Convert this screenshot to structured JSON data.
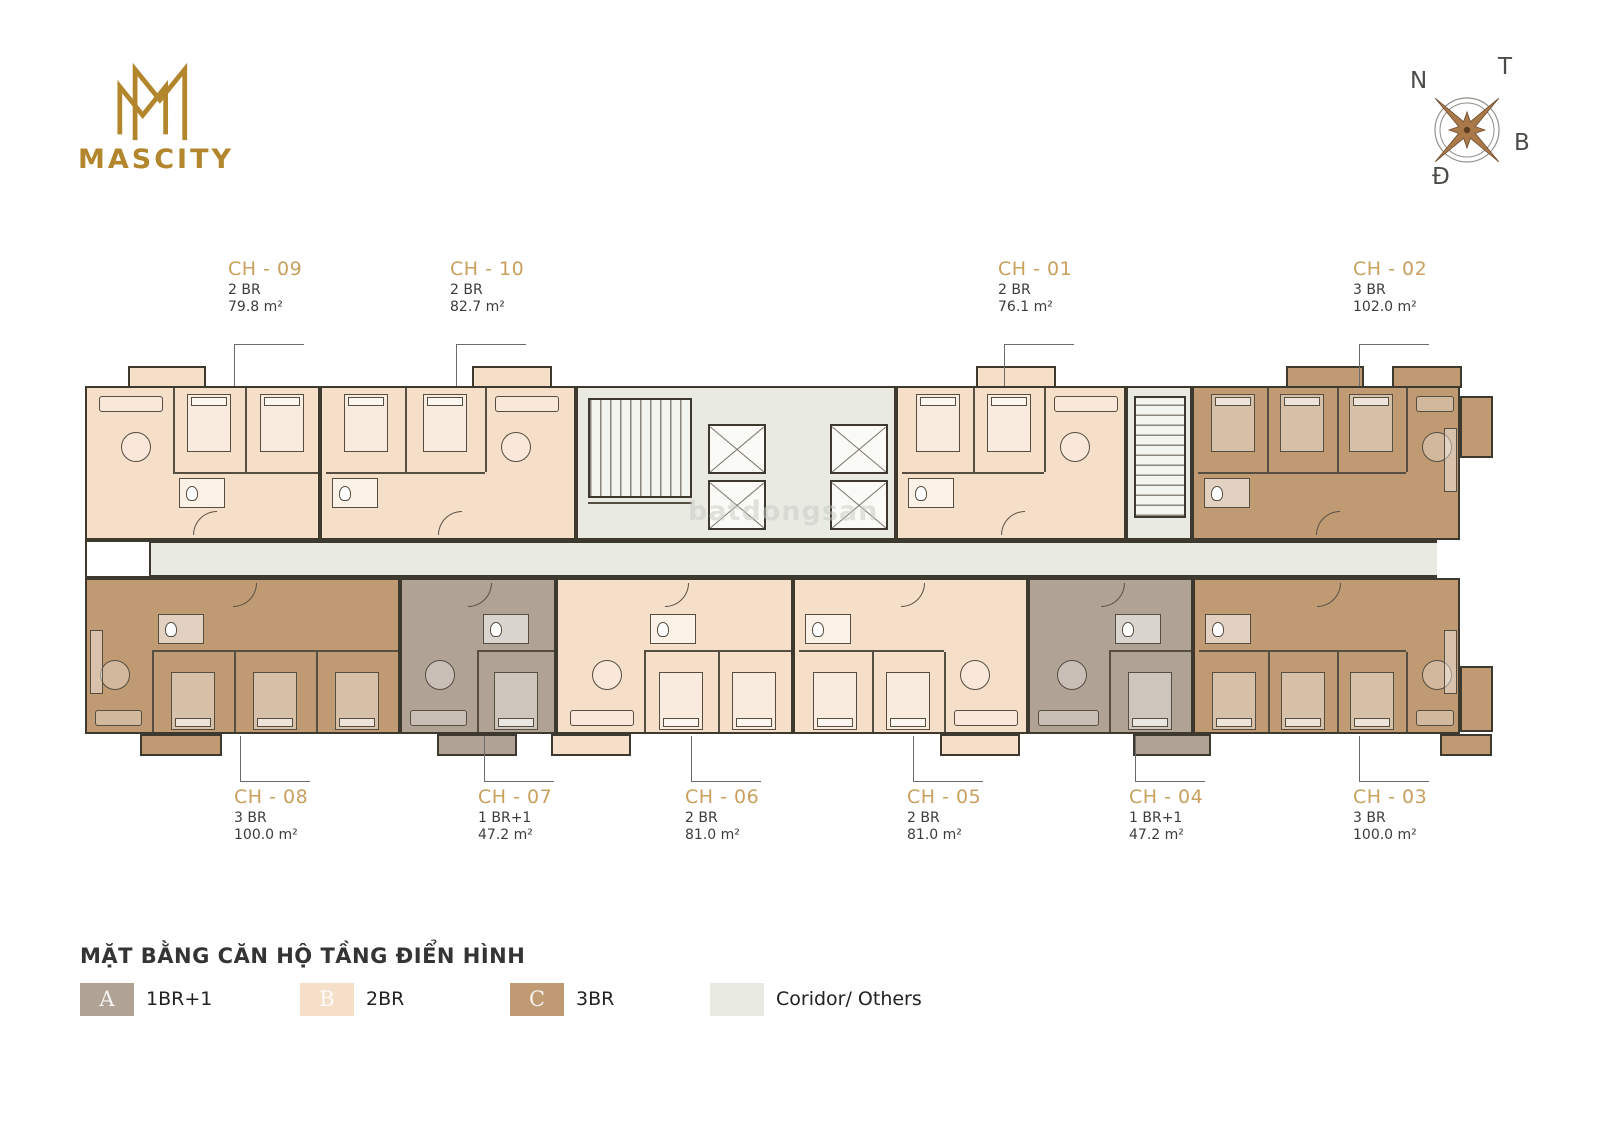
{
  "brand": {
    "logo_text": "MASCITY"
  },
  "compass": {
    "top_left": "N",
    "top_right": "T",
    "bottom_right": "B",
    "bottom_left": "Đ"
  },
  "watermark": {
    "text": "batdongsan"
  },
  "colors": {
    "gold": "#B1862C",
    "label_gold": "#C9A05E",
    "wall": "#3E392F",
    "wall2": "#554E41",
    "one_br": "#B0A295",
    "two_br": "#F6DFC9",
    "three_br": "#BF9A73",
    "corridor": "#E9EBE2"
  },
  "units": [
    {
      "id": "CH - 09",
      "bedrooms_label": "2 BR",
      "area": "79.8 m²",
      "type": "2BR"
    },
    {
      "id": "CH - 10",
      "bedrooms_label": "2 BR",
      "area": "82.7 m²",
      "type": "2BR"
    },
    {
      "id": "CH - 01",
      "bedrooms_label": "2 BR",
      "area": "76.1 m²",
      "type": "2BR"
    },
    {
      "id": "CH - 02",
      "bedrooms_label": "3 BR",
      "area": "102.0 m²",
      "type": "3BR"
    },
    {
      "id": "CH - 08",
      "bedrooms_label": "3 BR",
      "area": "100.0 m²",
      "type": "3BR"
    },
    {
      "id": "CH - 07",
      "bedrooms_label": "1 BR+1",
      "area": "47.2 m²",
      "type": "1BR+1"
    },
    {
      "id": "CH - 06",
      "bedrooms_label": "2 BR",
      "area": "81.0 m²",
      "type": "2BR"
    },
    {
      "id": "CH - 05",
      "bedrooms_label": "2 BR",
      "area": "81.0 m²",
      "type": "2BR"
    },
    {
      "id": "CH - 04",
      "bedrooms_label": "1 BR+1",
      "area": "47.2 m²",
      "type": "1BR+1"
    },
    {
      "id": "CH - 03",
      "bedrooms_label": "3 BR",
      "area": "100.0 m²",
      "type": "3BR"
    }
  ],
  "legend": {
    "title": "MẶT BẰNG CĂN HỘ TẦNG ĐIỂN HÌNH",
    "items": [
      {
        "letter": "A",
        "label": "1BR+1",
        "color_key": "one_br"
      },
      {
        "letter": "B",
        "label": "2BR",
        "color_key": "two_br"
      },
      {
        "letter": "C",
        "label": "3BR",
        "color_key": "three_br"
      },
      {
        "letter": "",
        "label": "Coridor/ Others",
        "color_key": "corridor"
      }
    ]
  }
}
